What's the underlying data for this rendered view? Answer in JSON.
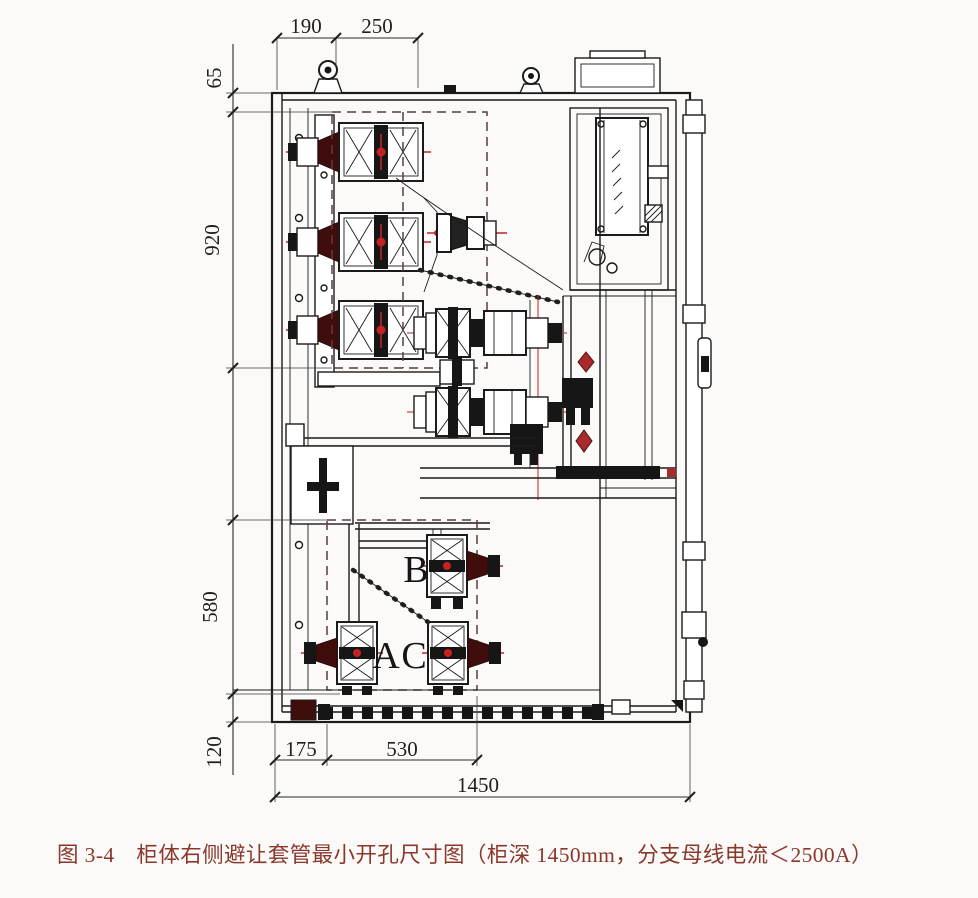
{
  "figure_caption": "图 3-4　柜体右侧避让套管最小开孔尺寸图（柜深 1450mm，分支母线电流＜2500A）",
  "dimensions": {
    "top_width_1": "190",
    "top_width_2": "250",
    "side_top_offset": "65",
    "side_upper_opening": "920",
    "side_lower_opening": "580",
    "side_bottom_offset": "120",
    "bottom_left_offset": "175",
    "bottom_opening_width": "530",
    "cabinet_depth": "1450"
  },
  "phase_labels": {
    "a": "A",
    "b": "B",
    "c": "C"
  },
  "colors": {
    "line": "#1b1b1b",
    "centerline_red": "#c32222",
    "bushing_maroon": "#400d0d",
    "dashed_opening": "#5a3c3c",
    "caption_text": "#8a372c",
    "background": "#fbfaf8"
  }
}
